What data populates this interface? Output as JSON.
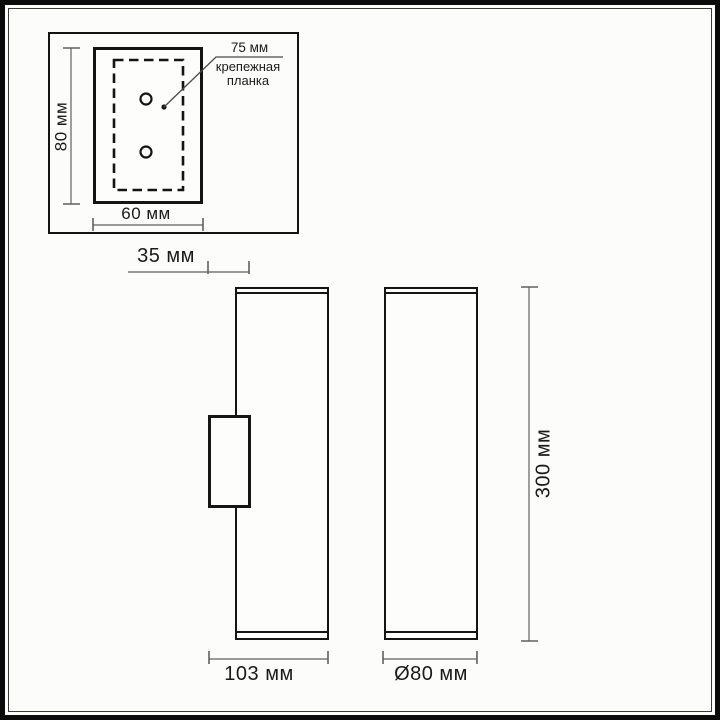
{
  "diagram": {
    "type": "technical-dimension-drawing",
    "subject": "wall-lamp two views with mounting plate detail",
    "colors": {
      "background": "#fcfcfb",
      "object_line": "#141414",
      "dimension_line": "#555555",
      "text": "#1a1a1a",
      "frame": "#0a0a0a"
    },
    "inset_detail": {
      "height_label": "80 мм",
      "width_label": "60 мм",
      "callout": {
        "value": "75 мм",
        "name_line1": "крепежная",
        "name_line2": "планка"
      },
      "hole_count": 2
    },
    "front_view": {
      "offset_label": "35 мм",
      "width_label": "103 мм"
    },
    "side_view": {
      "diameter_label": "Ø80 мм",
      "height_label": "300 мм"
    }
  }
}
